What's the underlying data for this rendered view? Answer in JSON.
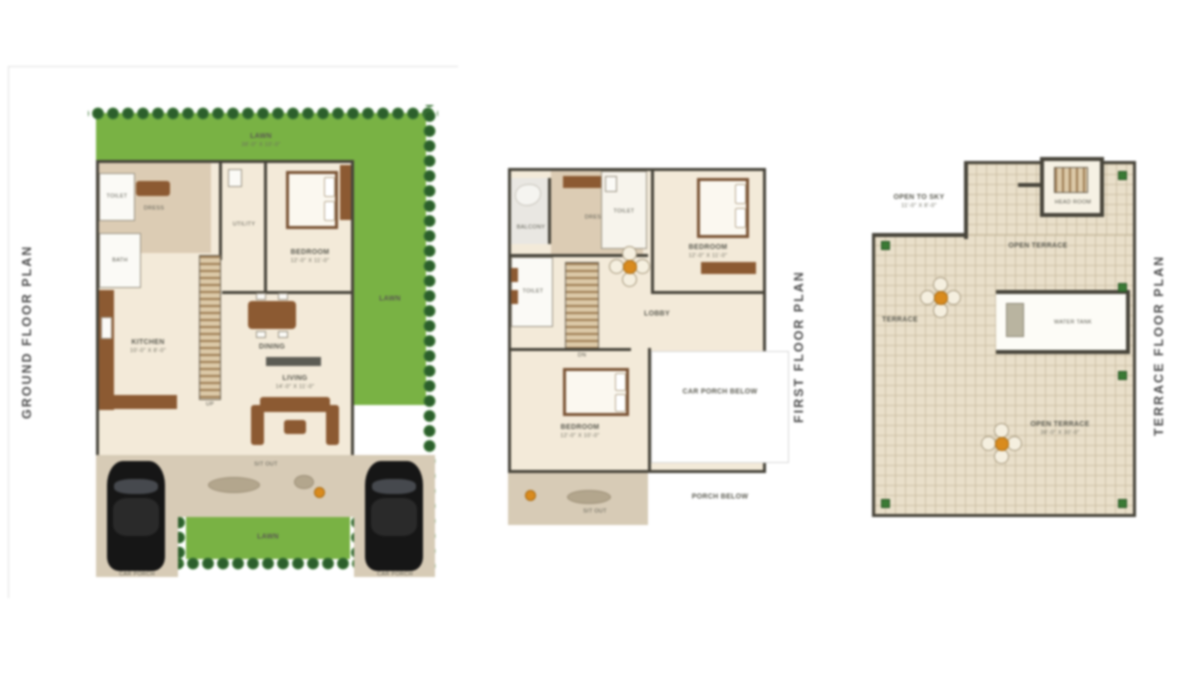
{
  "document": {
    "background": "#ffffff"
  },
  "colors": {
    "lawn": "#79b244",
    "hedge": "#2c5f2c",
    "floor_cream": "#f3ead9",
    "floor_tan": "#dcccb4",
    "wall": "#47443a",
    "wood": "#8c5a32",
    "terrace_tile": "#e9dfca",
    "car": "#161616",
    "accent_pot": "#d98b1e",
    "title_text": "#4b4b4b"
  },
  "plans": [
    {
      "title": "GROUND FLOOR PLAN",
      "labels": {
        "lawn_top": "LAWN",
        "lawn_top_dim": "38'-0\" X 10'-0\"",
        "lawn_right": "LAWN",
        "lawn_bottom": "LAWN",
        "bedroom": "BEDROOM",
        "bedroom_dim": "12'-0\" X 11'-0\"",
        "toilet": "TOILET",
        "bath": "BATH",
        "dress": "DRESS",
        "utility": "UTILITY",
        "kitchen": "KITCHEN",
        "kitchen_dim": "10'-0\" X 8'-0\"",
        "dining": "DINING",
        "living": "LIVING",
        "living_dim": "14'-0\" X 11'-0\"",
        "stair": "UP",
        "car_left": "CAR PORCH",
        "car_right": "CAR PORCH",
        "sitout": "SIT OUT"
      }
    },
    {
      "title": "FIRST FLOOR PLAN",
      "labels": {
        "balcony": "BALCONY",
        "dress": "DRESS",
        "toilet_top": "TOILET",
        "bedroom_top": "BEDROOM",
        "bedroom_top_dim": "12'-0\" X 11'-0\"",
        "lobby": "LOBBY",
        "toilet_left": "TOILET",
        "stair": "DN",
        "bedroom_bottom": "BEDROOM",
        "bedroom_bottom_dim": "12'-0\" X 10'-0\"",
        "terrace_below": "CAR PORCH BELOW",
        "porch_below": "PORCH BELOW",
        "sitout": "SIT OUT"
      }
    },
    {
      "title": "TERRACE FLOOR PLAN",
      "labels": {
        "open_sky": "OPEN TO SKY",
        "open_sky_dim": "11'-0\" X 8'-0\"",
        "head_room": "HEAD ROOM",
        "tank": "WATER TANK",
        "terrace_a": "OPEN TERRACE",
        "terrace_b": "TERRACE",
        "terrace_c": "OPEN TERRACE",
        "terrace_c_dim": "38'-0\" X 30'-0\""
      }
    }
  ]
}
